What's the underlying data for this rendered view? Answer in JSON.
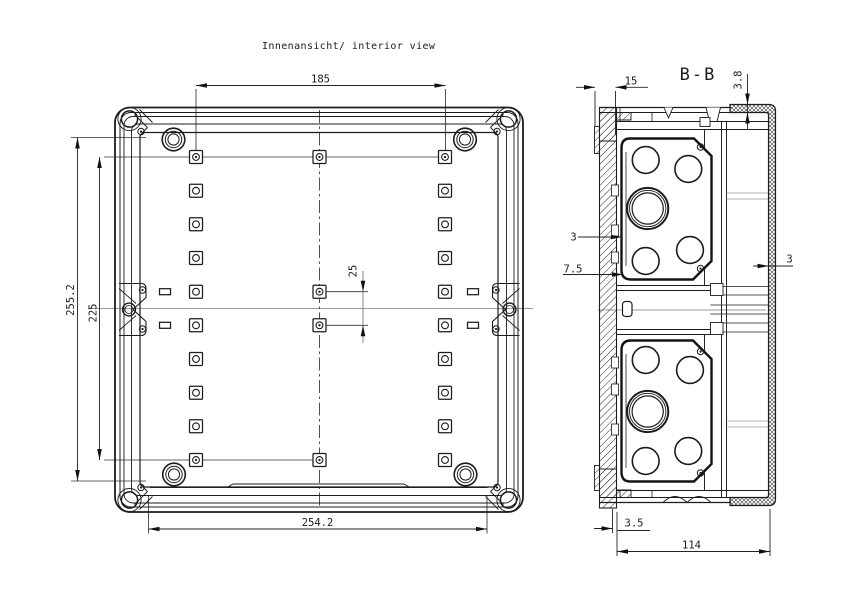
{
  "drawing": {
    "title": "Innenansicht/ interior view",
    "section_title": "B-B",
    "interior_view": {
      "dims": {
        "top_width": "185",
        "left_outer_height": "255.2",
        "left_inner_height": "225",
        "center_spacing": "25",
        "bottom_width": "254.2"
      },
      "hole_grid": {
        "columns_x": [
          196,
          319.5,
          445
        ],
        "rows_y": [
          157,
          190.7,
          224.3,
          258,
          291.7,
          325.3,
          359,
          392.7,
          426.3,
          460
        ],
        "middle_column_rows": [
          0,
          4,
          5,
          9
        ],
        "dot_cells": [
          [
            0,
            0
          ],
          [
            1,
            0
          ],
          [
            2,
            0
          ],
          [
            1,
            4
          ],
          [
            1,
            5
          ],
          [
            0,
            9
          ],
          [
            1,
            9
          ]
        ],
        "square_size": 13,
        "hole_radius": 3.4
      }
    },
    "section_view": {
      "dims": {
        "flange_inset": "15",
        "cover_thickness": "3.8",
        "wall_left": "3",
        "flange_depth": "7.5",
        "wall_right": "3",
        "base_offset": "3.5",
        "depth": "114"
      }
    },
    "colors": {
      "line": "#1c1c1c",
      "centerline": "#999999",
      "dimension": "#222222",
      "background": "#ffffff"
    }
  }
}
